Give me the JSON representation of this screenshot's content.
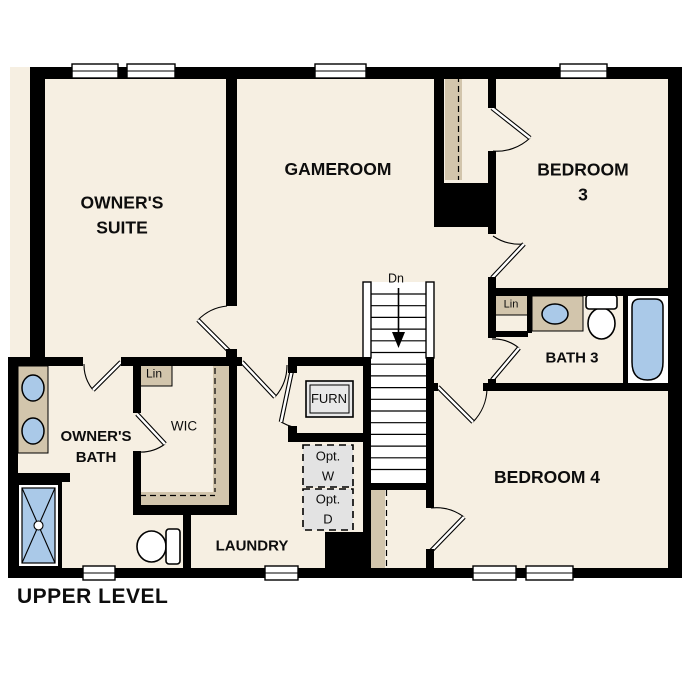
{
  "title": "UPPER LEVEL",
  "rooms": {
    "owners_suite": "OWNER'S\nSUITE",
    "gameroom": "GAMEROOM",
    "bedroom3": "BEDROOM 3",
    "bath3": "BATH 3",
    "bedroom4": "BEDROOM 4",
    "owners_bath": "OWNER'S\nBATH",
    "wic": "WIC",
    "laundry": "LAUNDRY"
  },
  "annotations": {
    "lin_wic": "Lin",
    "lin_bath3": "Lin",
    "furnace": "FURN",
    "opt_washer": "Opt.\nW",
    "opt_dryer": "Opt.\nD",
    "stairs_down": "Dn"
  },
  "colors": {
    "floor": "#f6efe2",
    "wall": "#000000",
    "cabinet_tan": "#d2c5ac",
    "fixture_blue": "#aac9e8",
    "appliance_gray": "#e3e3e3",
    "background": "#ffffff"
  }
}
